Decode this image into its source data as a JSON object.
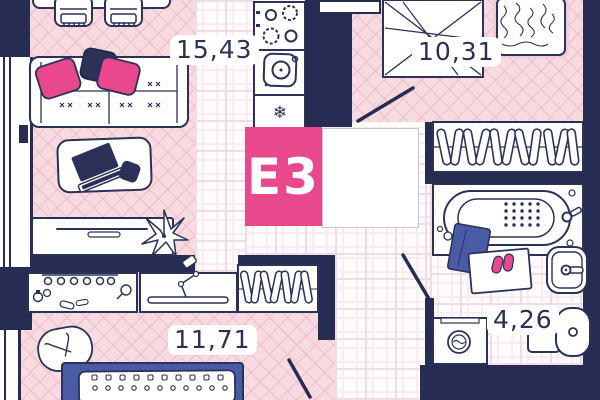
{
  "plan": {
    "code": "E3",
    "rooms": [
      {
        "name": "living-room-kitchen",
        "area": "15,43"
      },
      {
        "name": "bedroom-1",
        "area": "10,31"
      },
      {
        "name": "bedroom-2",
        "area": "11,71"
      },
      {
        "name": "bathroom",
        "area": "4,26"
      }
    ]
  },
  "icons": {
    "snowflake": "❄"
  },
  "colors": {
    "wall": "#262c52",
    "outline": "#2b3158",
    "accent_pink": "#e9498c",
    "floor_pink": "#f8dbe1",
    "tile_line": "#f2dbe2",
    "bed_blue": "#4a5ba6"
  }
}
